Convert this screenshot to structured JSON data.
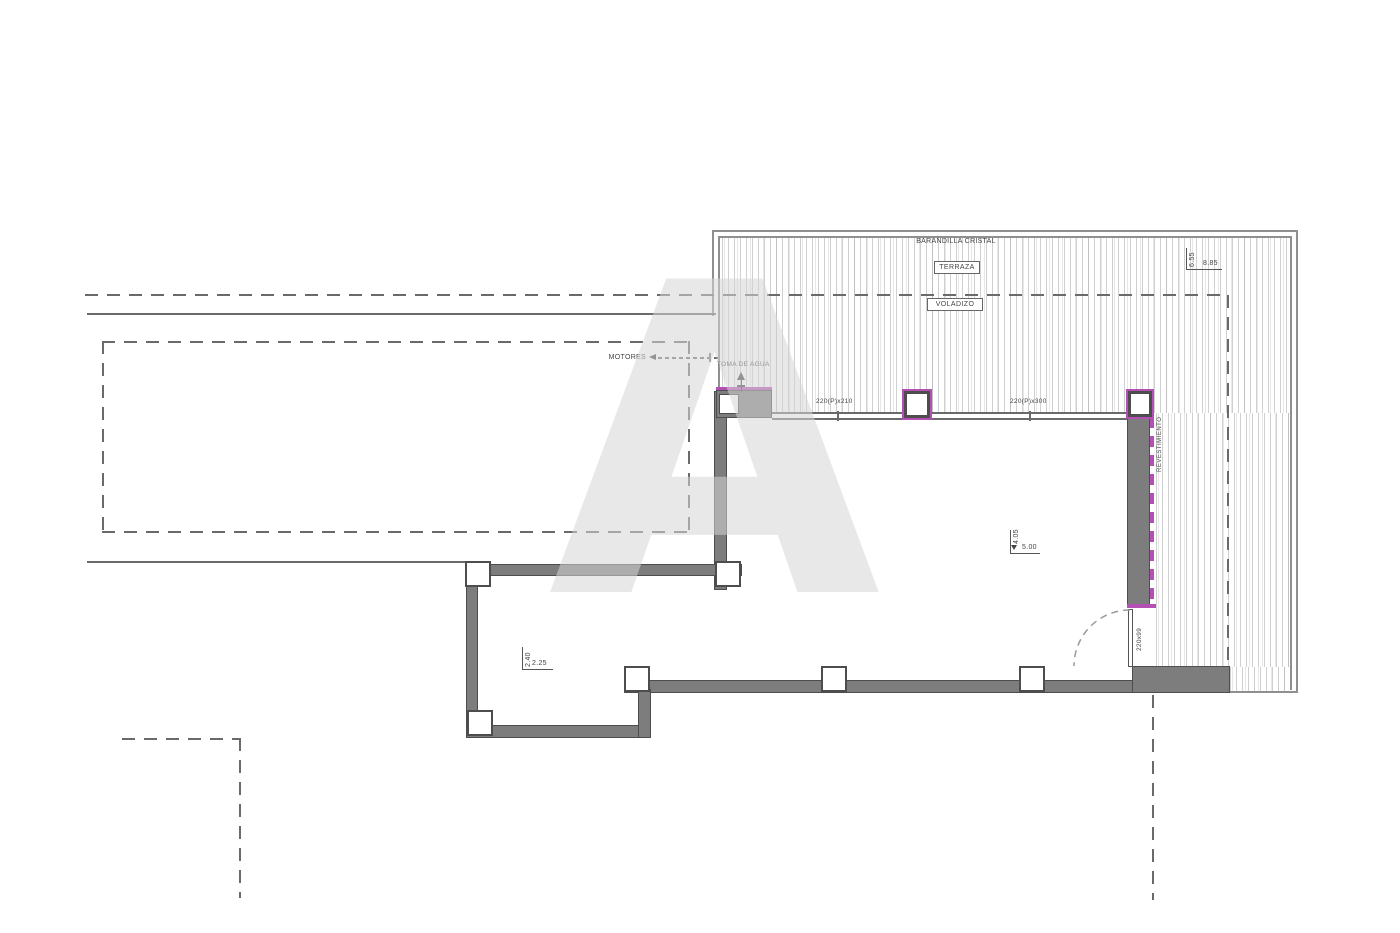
{
  "colors": {
    "wall": "#7d7d7d",
    "wall_dark": "#4d4d4d",
    "accent": "#b44fb4",
    "line": "#6a6a6a",
    "boundary": "#8f8f8f",
    "text": "#444444"
  },
  "labels": {
    "barandilla_cristal": "BARANDILLA CRISTAL",
    "terraza": "TERRAZA",
    "voladizo": "VOLADIZO",
    "motores": "MOTORES",
    "toma_de_agua": "TOMA DE AGUA",
    "revestimiento": "REVESTIMIENTO"
  },
  "dimensions": {
    "terrace_height": "6.55",
    "terrace_width": "8.85",
    "living_height": "4.05",
    "living_width": "5.00",
    "room_height": "2.40",
    "room_width": "2.25",
    "window_left": "220(P)x210",
    "window_right": "220(P)x300",
    "door": "220x99"
  },
  "watermark": {
    "letter": "A"
  }
}
